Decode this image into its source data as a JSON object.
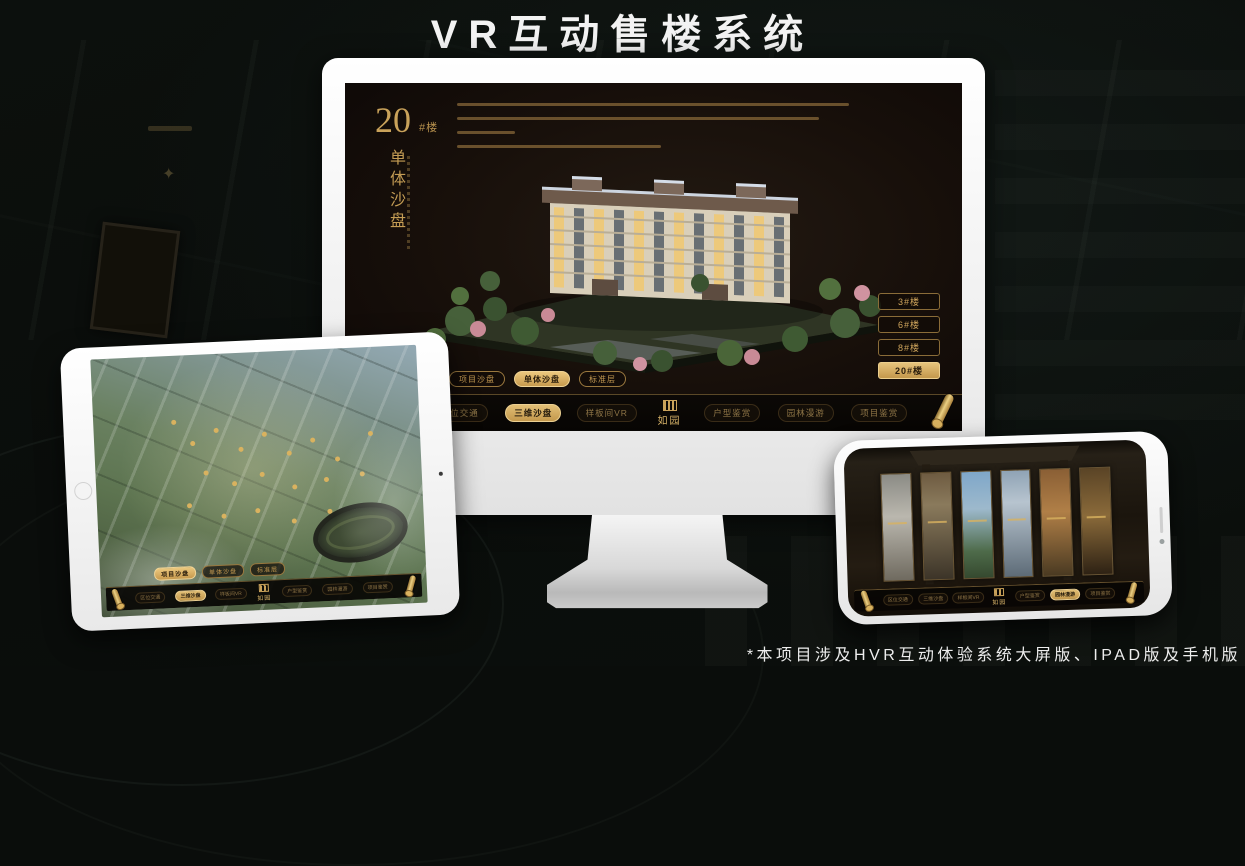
{
  "header": {
    "title": "VR互动售楼系统"
  },
  "footer": {
    "note": "*本项目涉及HVR互动体验系统大屏版、IPAD版及手机版"
  },
  "colors": {
    "gold": "#c9a25a",
    "gold_selected": "#d8b266",
    "screen_dark": "#17110c",
    "background": "#0b0e0c",
    "title_text": "#f3f3f3"
  },
  "monitor": {
    "headline": {
      "number": "20",
      "suffix": "#楼",
      "subtitle": "单体沙盘"
    },
    "floor_buttons": [
      {
        "label": "3#楼",
        "selected": false
      },
      {
        "label": "6#楼",
        "selected": false
      },
      {
        "label": "8#楼",
        "selected": false
      },
      {
        "label": "20#楼",
        "selected": true
      }
    ],
    "view_tabs": [
      {
        "label": "项目沙盘",
        "selected": false
      },
      {
        "label": "单体沙盘",
        "selected": true
      },
      {
        "label": "标准层",
        "selected": false
      }
    ],
    "nav": {
      "left": [
        {
          "label": "区位交通",
          "selected": false
        },
        {
          "label": "三维沙盘",
          "selected": true
        },
        {
          "label": "样板间VR",
          "selected": false
        }
      ],
      "logo": "如园",
      "right": [
        {
          "label": "户型鉴赏",
          "selected": false
        },
        {
          "label": "园林漫游",
          "selected": false
        },
        {
          "label": "项目鉴赏",
          "selected": false
        }
      ]
    }
  },
  "tablet": {
    "view_tabs": [
      {
        "label": "项目沙盘",
        "selected": true
      },
      {
        "label": "单体沙盘",
        "selected": false
      },
      {
        "label": "标准层",
        "selected": false
      }
    ],
    "nav": {
      "left": [
        {
          "label": "区位交通",
          "selected": false
        },
        {
          "label": "三维沙盘",
          "selected": true
        },
        {
          "label": "样板间VR",
          "selected": false
        }
      ],
      "logo": "如园",
      "right": [
        {
          "label": "户型鉴赏",
          "selected": false
        },
        {
          "label": "园林漫游",
          "selected": false
        },
        {
          "label": "项目鉴赏",
          "selected": false
        }
      ]
    }
  },
  "phone": {
    "nav": {
      "left": [
        {
          "label": "区位交通",
          "selected": false
        },
        {
          "label": "三维沙盘",
          "selected": false
        },
        {
          "label": "样板间VR",
          "selected": false
        }
      ],
      "logo": "如园",
      "right": [
        {
          "label": "户型鉴赏",
          "selected": false
        },
        {
          "label": "园林漫游",
          "selected": true
        },
        {
          "label": "项目鉴赏",
          "selected": false
        }
      ]
    }
  }
}
